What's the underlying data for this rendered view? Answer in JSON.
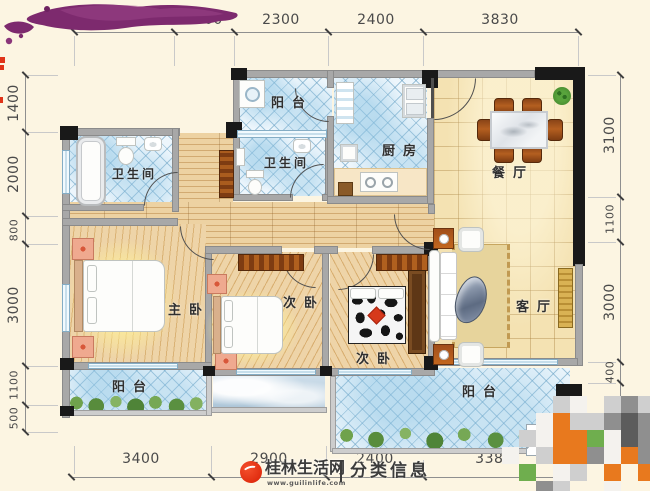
{
  "dims": {
    "top": [
      "2500",
      "1500",
      "2300",
      "2400",
      "3830"
    ],
    "left": [
      "1400",
      "2000",
      "800",
      "3000",
      "1100",
      "500"
    ],
    "right": [
      "3100",
      "1100",
      "3000",
      "400",
      "00"
    ],
    "bottom": [
      "3400",
      "2900",
      "2400",
      "3380"
    ]
  },
  "rooms": {
    "balcony_top": "阳台",
    "kitchen": "厨房",
    "dining": "餐厅",
    "bath_left": "卫生间",
    "bath_mid": "卫生间",
    "master": "主卧",
    "bedroom_mid": "次卧",
    "bedroom_lower": "次卧",
    "living": "客厅",
    "balcony_left": "阳台",
    "balcony_right": "阳台"
  },
  "watermark": {
    "site": "桂林生活网",
    "url": "www.guilinlife.com",
    "section": "分类信息"
  },
  "colors": {
    "wall": "#a8a8a8",
    "column": "#191919",
    "tile_line": "#6fa9cc",
    "floor_wood": "#e9cd9e",
    "floor_beige": "#f4e2b2",
    "watermark_red": "#e23415",
    "purple_blob": "#7d2a6e"
  },
  "mosaic": {
    "cell": 17,
    "palette": {
      "l": "#cfcfcf",
      "d": "#8f8f8f",
      "k": "#5c5c5c",
      "w": "#f4f2ee",
      "o": "#e8791e",
      "g": "#6fae4e",
      "c": "#efe5cf"
    },
    "rows": [
      "...lw.ldl",
      "..wolldkd",
      ".lwoogwkd",
      "w.loodwod",
      ".g.wl.o.o",
      "..dl..w.."
    ]
  }
}
